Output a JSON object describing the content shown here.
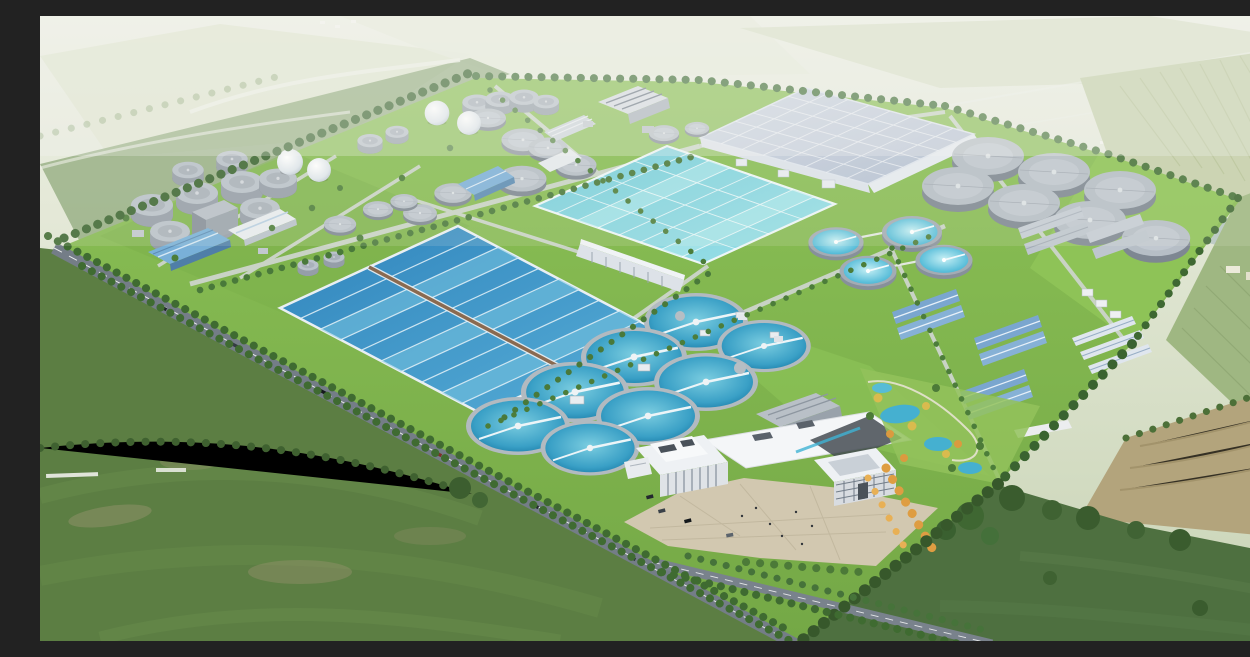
{
  "scene": {
    "title": "Aerial rendering of a large wastewater treatment plant campus",
    "subject": "Bird's-eye architectural rendering of a sewage / wastewater treatment plant set in green farmland",
    "view": "oblique aerial perspective from the south-west, hazy horizon at top",
    "environment": "surrounded by flat farmland, hedgerows, tree-lined country roads and a distant village",
    "site": {
      "shape": "diamond-oriented rectangular campus bounded by tree-lined roads",
      "zones": [
        {
          "name": "sludge-digestion-tank-farm",
          "description": "cluster of grey cylindrical digesters, thickeners and two white gas-holder spheres, north-west corner"
        },
        {
          "name": "pretreatment-works",
          "description": "small covered grey tanks, arched hall and workshop buildings along the northern edge"
        },
        {
          "name": "covered-treatment-basin",
          "description": "very large flat light-grey covered basin with structural grid, north-east quadrant"
        },
        {
          "name": "aeration-basin",
          "description": "large pale-cyan rectangular basin with lane markings, centre"
        },
        {
          "name": "oxidation-ditch-basin",
          "description": "large deep-blue rectangular basin with white serpentine channel lanes and a brown centre walkway, west-centre"
        },
        {
          "name": "secondary-clarifier-field",
          "description": "two diagonal rows of round blue clarifiers with white scraper bridges, centre"
        },
        {
          "name": "covered-clarifier-cluster",
          "description": "seven grey covered circular tanks, east"
        },
        {
          "name": "process-building-rows",
          "description": "pairs of blue-roofed gabled halls and grey flat-roofed buildings, south-east quadrant"
        },
        {
          "name": "administration-campus",
          "description": "two white modern office buildings with a wide white canopy roof, paved plaza with cars and people, south"
        },
        {
          "name": "landscaped-garden",
          "description": "ornamental ponds, winding paths and yellow-orange autumn trees east of the plaza"
        }
      ]
    },
    "infrastructure": {
      "main_road": "dual tree-lined road running diagonally along the south-west boundary",
      "branch_road": "secondary road leaving the main gate toward the south-east",
      "internal_roads": "light concrete service roads on a skewed grid with tree rows"
    },
    "element_counts": {
      "blue_secondary_clarifiers": 8,
      "grey_covered_circular_tanks_east": 7,
      "grey_covered_circular_tanks_north": 8,
      "cylindrical_digester_silos": 12,
      "white_gas_holder_spheres": 4,
      "light_blue_round_tanks": 4,
      "large_rectangular_basins": 3,
      "blue_roofed_halls": 6,
      "white_admin_buildings": 2
    },
    "palette": {
      "haze_sky": "#e9ece1",
      "background_fields": "#d6dfc6",
      "site_grass": "#84b94f",
      "dark_foreground_field": "#55753f",
      "tree_green": "#3e6832",
      "deep_basin_water": "#3589c0",
      "aeration_water": "#7fd3df",
      "clarifier_water": "#2a93bd",
      "covered_basin_grey": "#c6cfdc",
      "tank_grey": "#b7bfc7",
      "blue_roof": "#7aa6cf",
      "admin_white": "#f4f6f8",
      "plaza_paving": "#d2c8b0",
      "autumn_tree_orange": "#de9d42",
      "asphalt_road": "#747d87"
    }
  }
}
